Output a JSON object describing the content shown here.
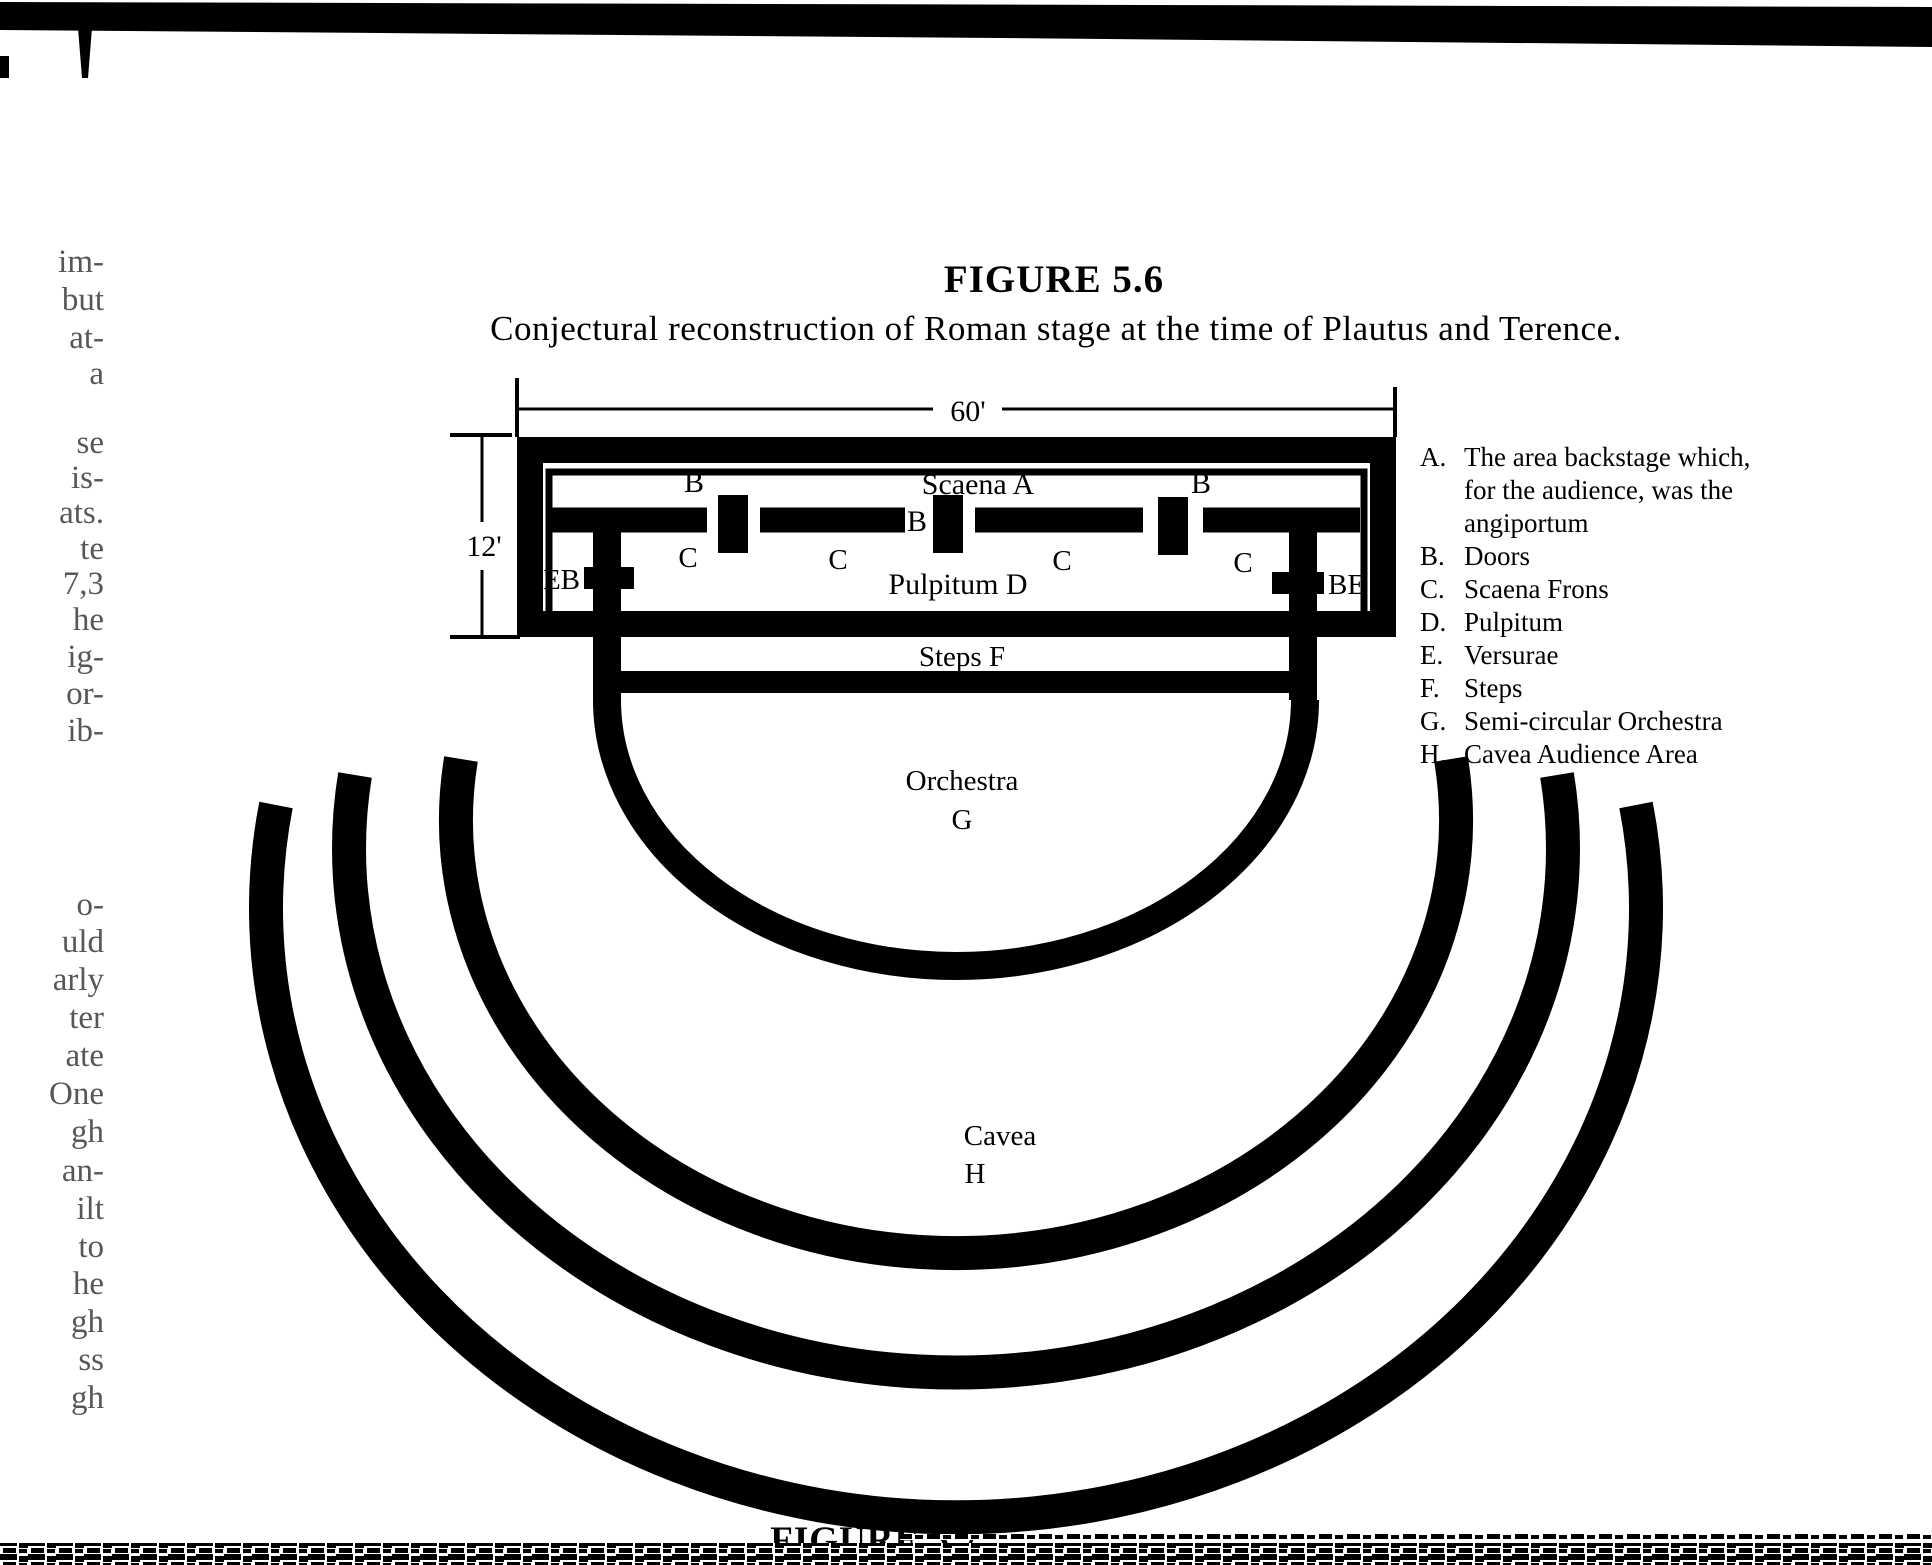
{
  "page": {
    "figure_label": "FIGURE 5.6",
    "figure_caption": "Conjectural reconstruction of Roman stage at the time of Plautus and Terence.",
    "next_figure_label": "FIGURE 5.7"
  },
  "colors": {
    "ink": "#000000",
    "paper": "#ffffff"
  },
  "diagram": {
    "width_label": "60'",
    "depth_label": "12'",
    "scaena_label": "Scaena  A",
    "door_top_left": "B",
    "door_top_right": "B",
    "door_center": "B",
    "c1": "C",
    "c2": "C",
    "c3": "C",
    "c4": "C",
    "pulpitum_label": "Pulpitum  D",
    "versura_left_label": "EB",
    "versura_right_label": "BE",
    "steps_label": "Steps F",
    "orchestra_label": "Orchestra",
    "orchestra_letter": "G",
    "cavea_label": "Cavea",
    "cavea_letter": "H"
  },
  "legend": {
    "rows": [
      {
        "letter": "A.",
        "text": "The area backstage which,"
      },
      {
        "letter": "",
        "text": "for the audience, was the"
      },
      {
        "letter": "",
        "text": "angiportum"
      },
      {
        "letter": "B.",
        "text": "Doors"
      },
      {
        "letter": "C.",
        "text": "Scaena Frons"
      },
      {
        "letter": "D.",
        "text": "Pulpitum"
      },
      {
        "letter": "E.",
        "text": "Versurae"
      },
      {
        "letter": "F.",
        "text": "Steps"
      },
      {
        "letter": "G.",
        "text": "Semi-circular Orchestra"
      },
      {
        "letter": "H.",
        "text": "Cavea Audience Area"
      }
    ]
  },
  "margin_fragments": [
    "im-",
    "but",
    "at-",
    "a",
    "se",
    "is-",
    "ats.",
    "te",
    "7,3",
    "he",
    "ig-",
    "or-",
    "ib-",
    "o-",
    "uld",
    "arly",
    "ter",
    "ate",
    "One",
    "gh",
    "an-",
    "ilt",
    "to",
    "he",
    "gh",
    "ss",
    "gh"
  ]
}
